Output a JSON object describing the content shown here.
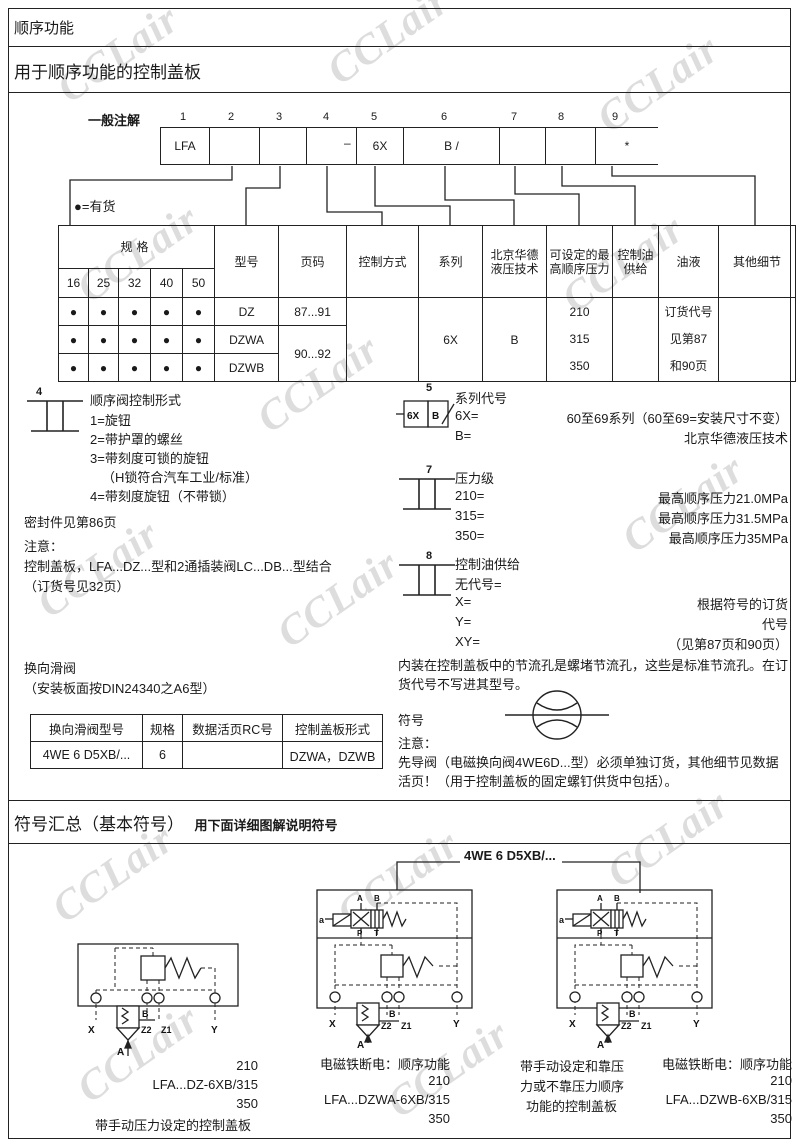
{
  "page": {
    "title": "顺序功能",
    "subtitle": "用于顺序功能的控制盖板",
    "watermark": "CCLair"
  },
  "ordering": {
    "label": "一般注解",
    "positions": [
      "1",
      "2",
      "3",
      "4",
      "5",
      "6",
      "7",
      "8",
      "9"
    ],
    "cells": [
      "LFA",
      "",
      "",
      "",
      "6X",
      "B /",
      "",
      "",
      "*"
    ],
    "dash": "–",
    "availability": "●=有货"
  },
  "main_table": {
    "headers": {
      "spec": "规格",
      "sizes": [
        "16",
        "25",
        "32",
        "40",
        "50"
      ],
      "model": "型号",
      "page": "页码",
      "control": "控制方式",
      "series": "系列",
      "tech": "北京华德液压技术",
      "pressure": "可设定的最高顺序压力",
      "oil": "控制油供给",
      "fluid": "油液",
      "other": "其他细节"
    },
    "rows": {
      "dot": "●",
      "models": [
        "DZ",
        "DZWA",
        "DZWB"
      ],
      "pages_row1": "87...91",
      "pages_row23": "90...92",
      "series": "6X",
      "tech": "B",
      "pressures": [
        "210",
        "315",
        "350"
      ],
      "fluid_lines": [
        "订货代号",
        "见第87",
        "和90页"
      ]
    }
  },
  "item4": {
    "num": "4",
    "title": "顺序阀控制形式",
    "options": [
      "1=旋钮",
      "2=带护罩的螺丝",
      "3=带刻度可锁的旋钮",
      "（H锁符合汽车工业/标准）",
      "4=带刻度旋钮（不带锁）"
    ]
  },
  "seals_note": "密封件见第86页",
  "notice": {
    "label": "注意：",
    "lines": [
      "控制盖板，LFA...DZ...型和2通插装阀LC...DB...型结合",
      "（订货号见32页）"
    ]
  },
  "item5": {
    "num": "5",
    "title": "系列代号",
    "sym": {
      "left": "6X",
      "right": "B"
    },
    "rows": [
      [
        "6X=",
        "60至69系列（60至69=安装尺寸不变）"
      ],
      [
        "B=",
        "北京华德液压技术"
      ]
    ]
  },
  "item7": {
    "num": "7",
    "title": "压力级",
    "rows": [
      [
        "210=",
        "最高顺序压力21.0MPa"
      ],
      [
        "315=",
        "最高顺序压力31.5MPa"
      ],
      [
        "350=",
        "最高顺序压力35MPa"
      ]
    ]
  },
  "item8": {
    "num": "8",
    "title": "控制油供给",
    "rows": [
      [
        "无代号=",
        ""
      ],
      [
        "X=",
        "根据符号的订货"
      ],
      [
        "Y=",
        "代号"
      ],
      [
        "XY=",
        "（见第87页和90页）"
      ]
    ]
  },
  "spool": {
    "title": "换向滑阀",
    "subtitle": "（安装板面按DIN24340之A6型）",
    "headers": [
      "换向滑阀型号",
      "规格",
      "数据活页RC号",
      "控制盖板形式"
    ],
    "row": [
      "4WE 6 D5XB/...",
      "6",
      "",
      "DZWA，DZWB"
    ]
  },
  "orifice": {
    "para": "内装在控制盖板中的节流孔是螺堵节流孔，这些是标准节流孔。在订货代号不写进其型号。",
    "symbol_label": "符号",
    "notice_label": "注意：",
    "pilot": "先导阀（电磁换向阀4WE6D...型）必须单独订货，其他细节见数据活页！（用于控制盖板的固定螺钉供货中包括）。"
  },
  "symbols": {
    "title": "符号汇总（基本符号）",
    "suffix": "用下面详细图解说明符号",
    "valve_label": "4WE 6 D5XB/...",
    "captions": {
      "left": [
        "210",
        "LFA...DZ-6XB/315",
        "350",
        "带手动压力设定的控制盖板"
      ],
      "middle": [
        "电磁铁断电：顺序功能",
        "210",
        "LFA...DZWA-6XB/315",
        "350"
      ],
      "note": [
        "带手动设定和靠压",
        "力或不靠压力顺序",
        "功能的控制盖板"
      ],
      "right": [
        "电磁铁断电：顺序功能",
        "210",
        "LFA...DZWB-6XB/315",
        "350"
      ]
    },
    "ports": {
      "x": "X",
      "z2": "Z2",
      "z1": "Z1",
      "y": "Y",
      "a": "A",
      "b": "B",
      "sol": "a",
      "pA": "A",
      "pB": "B",
      "pP": "P",
      "pT": "T"
    }
  }
}
